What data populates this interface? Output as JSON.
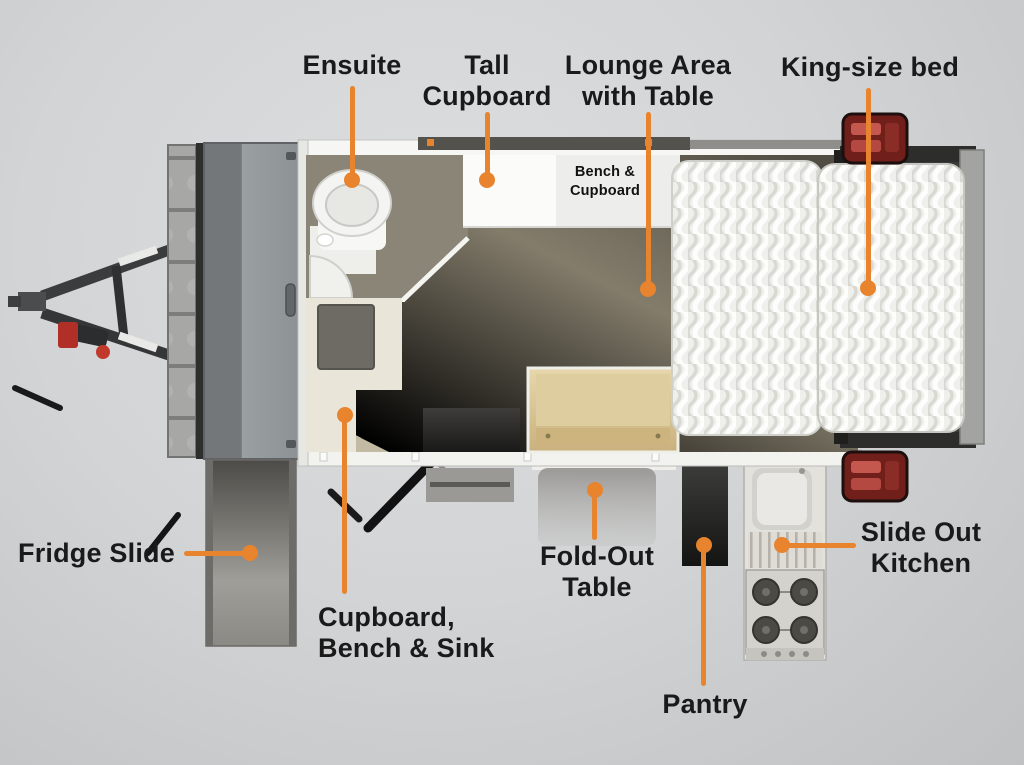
{
  "colors": {
    "accent": "#E8832E",
    "label_text": "#1a1a1a",
    "background_top": "#dcdee0",
    "background_bottom": "#bfc1c3"
  },
  "callouts": {
    "ensuite": {
      "lines": [
        "Ensuite"
      ]
    },
    "tall_cupboard": {
      "lines": [
        "Tall",
        "Cupboard"
      ]
    },
    "lounge_area": {
      "lines": [
        "Lounge Area",
        "with Table"
      ]
    },
    "king_bed": {
      "lines": [
        "King-size bed"
      ]
    },
    "fridge_slide": {
      "lines": [
        "Fridge Slide"
      ]
    },
    "cupboard_bench_sink": {
      "lines": [
        "Cupboard,",
        "Bench & Sink"
      ]
    },
    "fold_out_table": {
      "lines": [
        "Fold-Out",
        "Table"
      ]
    },
    "pantry": {
      "lines": [
        "Pantry"
      ]
    },
    "slide_out_kitchen": {
      "lines": [
        "Slide Out",
        "Kitchen"
      ]
    }
  },
  "floorplan": {
    "bench_cupboard": {
      "lines": [
        "Bench &",
        "Cupboard"
      ]
    }
  }
}
